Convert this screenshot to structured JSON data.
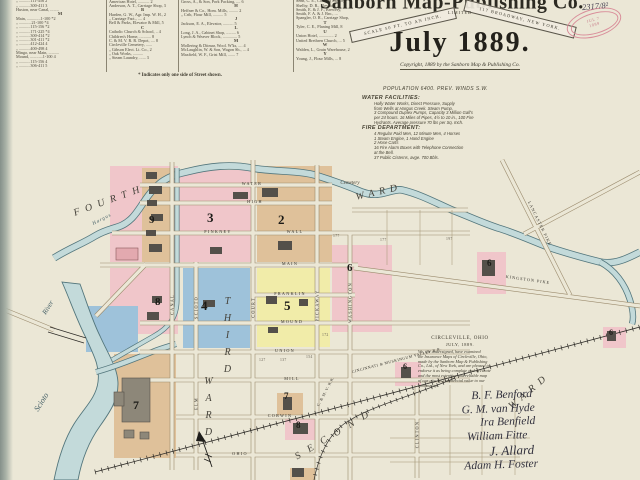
{
  "palette": {
    "paper": "#ebe7d6",
    "ink": "#3a372e",
    "water_fill": "#c3dada",
    "water_edge": "#53767c",
    "pink": "#f0c6ca",
    "tan": "#dfc19a",
    "yellow": "#f1eca9",
    "blue": "#9ec2da",
    "street_edge": "#9b8b6d",
    "stamp_pink": "#d98e9a"
  },
  "title": {
    "publisher": "Sanborn Map-Publishing Co.",
    "scale": "SCALE 50 FT. TO AN INCH.",
    "limited": "LIMITED",
    "address": "117 BROADWAY, NEW YORK.",
    "date": "July 1889.",
    "copyright": "Copyright, 1889 by the Sanborn Map & Publishing Co.",
    "stamp1": "JUL 7",
    "stamp2": "1889",
    "annotation": "2317/8²"
  },
  "info": {
    "population": "POPULATION 6400.  PREV. WINDS S.W.",
    "water_title": "WATER FACILITIES:",
    "water_lines": [
      "Holly Water Works, Direct Pressure, Supply",
      "from Wells at Hargus Creek. Steam Pump,",
      "3 Compound Duplex Pumps, Capacity 3 Million Gall's",
      "per 24 hours. 16 Miles of Pipes, 4½ to 10 in., 100 Fire",
      "Hydrants. Average pressure 70 lbs per Sq. Inch."
    ],
    "fire_title": "FIRE DEPARTMENT:",
    "fire_lines": [
      "4 Regular Paid Men, 12 Minute Men, 4 Horses",
      "1 Steam Engine, 1 Hand Engine",
      "2 Hose Carts",
      "16 Fire Alarm Boxes with Telephone Connection",
      "at the Bell.",
      "37 Public Cisterns, avge. 700 Bbls."
    ]
  },
  "index": {
    "col1": [
      "High, ...........112-225   2",
      "  „  ...........111-456   2",
      "  „  ...........300-411   3",
      "Huston, near Canal, ........",
      {
        "text": "M",
        "cls": "ihdr"
      },
      "Main, .............1-100  *2",
      "  „  ............21-100  *4",
      "  „  ...........115-156  *2",
      "  „  ...........171-225  *4",
      "  „  ...........300-414  *2",
      "  „  ...........301-411  *2",
      "  „  ...........412-424   4",
      "  „  ...........400-498   4",
      "Mingo, near Main, ..........",
      "Mound, ............1-100   4",
      "  „  ...........115-156   4",
      "  „  ...........306-411   5"
    ],
    "col2": [
      {
        "text": "A",
        "cls": "ihdr"
      },
      "American Hotel, ........... 2",
      "Anderson, A. T., Carriage Shop, 3",
      {
        "text": "B",
        "cls": "ihdr"
      },
      "Harden, G. W., Agr. Imp. W. H., 2",
      "   „   Carriage Fact., .... 4",
      "Bell & Parks, Elevator & Mill, 5",
      {
        "text": "C",
        "cls": "ihdr"
      },
      "Catholic Church & School, .. 4",
      "Children's Home, ........... 8",
      "C. & M. V. R. R. Depot, .... 8",
      "Circleville Cemetery, ......",
      "   „   Gibson Elect. Lt. Co., 2",
      "   „   Oak Works, ..........",
      "   „   Steam Laundry, ...... 3"
    ],
    "col3": [
      {
        "text": "G",
        "cls": "ihdr"
      },
      "Gross, A., & Son, Pork Packing, .... 6",
      {
        "text": "H",
        "cls": "ihdr"
      },
      "Heffner & Co., Hom. Mills, ......... 2",
      "   „   Crib, Flour Mill, .......... 5",
      {
        "text": "J",
        "cls": "ihdr"
      },
      "Jackson, E. A., Elevator, .......... 5",
      {
        "text": "L",
        "cls": "ihdr"
      },
      "Long, J. A., Cabinet Shop, ......... 6",
      "Lynch & Weaver Block, .............. 5",
      {
        "text": "M",
        "cls": "ihdr"
      },
      "Mollering & Ditmar, Wool. W'ks, .... 4",
      "McLaughlin, W. & Son, Wagon Sh., ... 4",
      "Maxfield, W. F., Grist Mill, ....... 7"
    ],
    "col4": [
      "Barrett's Building, .......",
      "Senn, C. E., Canning Factory,",
      "Shelby, D. R., Elevator, ..",
      "Smith, E. & J. F., Brewery,",
      "Smith, F. A. & J. Bro., ...",
      "Spangler, O. R., Carriage Shop,",
      {
        "text": "T",
        "cls": "ihdr"
      },
      "Tyler, C. E., Planing Mill, 8",
      {
        "text": "U",
        "cls": "ihdr"
      },
      "Union Hotel, .............. 2",
      "United Brethren Church, ... 5",
      {
        "text": "W",
        "cls": "ihdr"
      },
      "Walden, L., Grain Warehouse, 2",
      {
        "text": "Y",
        "cls": "ihdr"
      },
      "Young, J., Flour Mills, ... 8"
    ],
    "note": "* Indicates only one side of Street shown."
  },
  "map": {
    "h": {
      "water": "WATER",
      "high": "HIGH",
      "pinkney": "PINKNEY",
      "wall": "WALL",
      "main": "MAIN",
      "franklin": "FRANKLIN",
      "mound": "MOUND",
      "union": "UNION",
      "mill": "MILL",
      "corwin": "CORWIN",
      "ohio": "OHIO"
    },
    "v": {
      "canal": "CANAL",
      "scioto": "SCIOTO",
      "court": "COURT",
      "pickaway": "PICKAWAY",
      "washington": "WASHINGTON",
      "elm": "ELM",
      "clinton": "CLINTON"
    },
    "roads": {
      "lancaster": "LANCASTER PIKE",
      "kingston": "KINGSTON PIKE"
    },
    "rr": {
      "main_label": "CINCINNATI & MUSKINGUM VALLEY R.R.",
      "branch": "C. & M. V. R.R."
    },
    "wards": {
      "fourth": "FOURTH",
      "ward_ne": "WARD",
      "third": "THIRD",
      "ward_mid": "WARD",
      "second": "SECOND",
      "ward_se": "WARD"
    },
    "water_labels": {
      "hargus": "Hargus",
      "river1": "River",
      "river2": "Scioto"
    },
    "cemetery": "Cemetery",
    "sheets": {
      "s2": "2",
      "s3": "3",
      "s4": "4",
      "s5": "5",
      "s6a": "6",
      "s6b": "6",
      "s6c": "6",
      "s6d": "6",
      "s7a": "7",
      "s7b": "7",
      "s8a": "8",
      "s8b": "8",
      "s9": "9"
    },
    "plat": {
      "a": "127",
      "b": "137",
      "c": "154",
      "d": "172",
      "e": "177",
      "f": "177",
      "g": "197"
    }
  },
  "endorsement": {
    "place": "CIRCLEVILLE, OHIO",
    "date": "JULY, 1889.",
    "lines": [
      "We, the undersigned, have examined",
      "the Insurance Maps of Circleville, Ohio,",
      "made by the Sanborn Map & Publishing",
      "Co., Ltd., of New York, and are pleased to",
      "endorse it as being complete and accurate",
      "and the most extensive and reliable map",
      "of our city. Its commercial value to our",
      "community."
    ],
    "signatures": [
      "B. F. Benford",
      "G. M. van Hyde",
      "Ira Benfield",
      "William Fitte",
      "J. Allard",
      "Adam H. Foster"
    ]
  }
}
